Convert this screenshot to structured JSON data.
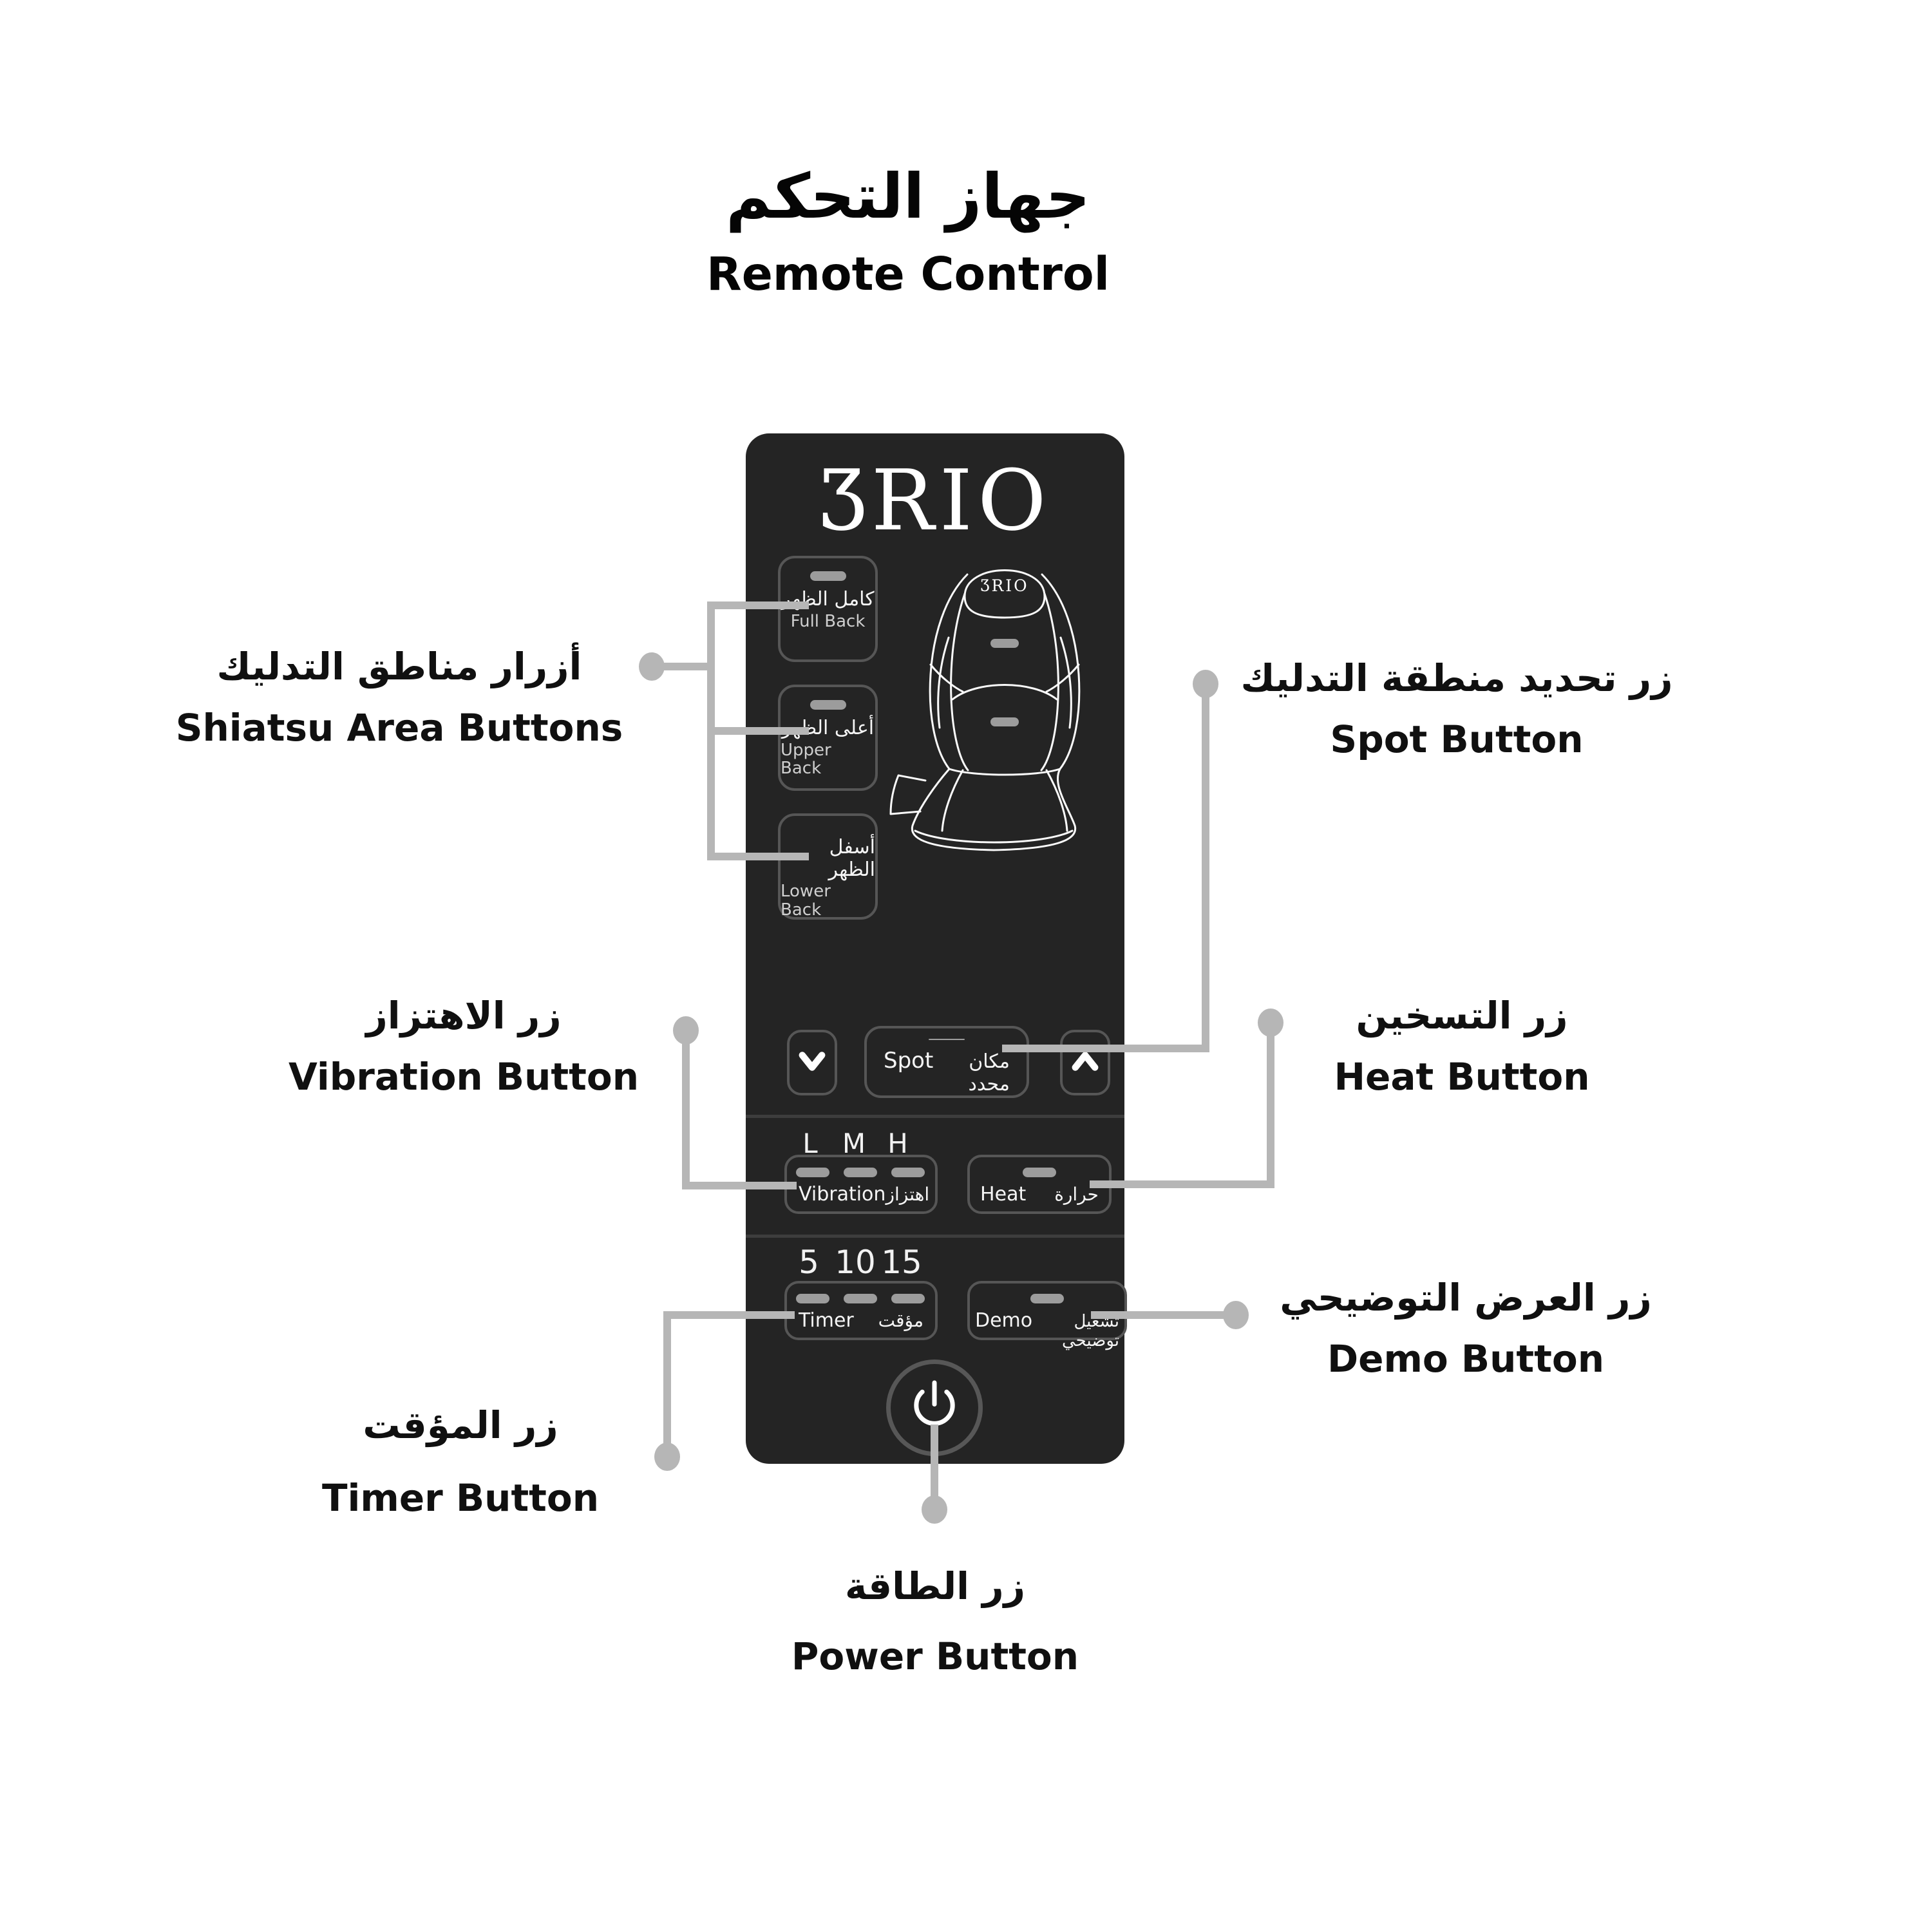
{
  "title": {
    "ar": "جهاز التحكم",
    "en": "Remote Control"
  },
  "brand": {
    "name": "BRIO",
    "stylized": "ƷRIO"
  },
  "remote": {
    "area_buttons": [
      {
        "ar": "كامل الظهر",
        "en": "Full Back"
      },
      {
        "ar": "أعلى الظهر",
        "en": "Upper Back"
      },
      {
        "ar": "أسفل الظهر",
        "en": "Lower Back"
      }
    ],
    "spot": {
      "en": "Spot",
      "ar": "مكان محدد"
    },
    "vibration": {
      "levels": [
        "L",
        "M",
        "H"
      ],
      "en": "Vibration",
      "ar": "اهتزاز"
    },
    "heat": {
      "en": "Heat",
      "ar": "حرارة"
    },
    "timer": {
      "durations": [
        "5",
        "10",
        "15"
      ],
      "en": "Timer",
      "ar": "مؤقت"
    },
    "demo": {
      "en": "Demo",
      "ar": "تشغيل توضيحي"
    }
  },
  "labels": {
    "shiatsu": {
      "ar": "أزرار مناطق التدليك",
      "en": "Shiatsu Area Buttons"
    },
    "spot": {
      "ar": "زر تحديد منطقة التدليك",
      "en": "Spot Button"
    },
    "vibration": {
      "ar": "زر الاهتزاز",
      "en": "Vibration Button"
    },
    "heat": {
      "ar": "زر التسخين",
      "en": "Heat Button"
    },
    "timer": {
      "ar": "زر المؤقت",
      "en": "Timer Button"
    },
    "demo": {
      "ar": "زر العرض التوضيحي",
      "en": "Demo Button"
    },
    "power": {
      "ar": "زر الطاقة",
      "en": "Power Button"
    }
  },
  "icons": {
    "chevron_down": "∨",
    "chevron_up": "∧",
    "power": "⏻"
  },
  "colors": {
    "remote_bg": "#242424",
    "button_border": "#565656",
    "led": "#9c9c9c",
    "callout": "#b6b6b6",
    "divider": "#3d3d3d",
    "text_light": "#f5f5f5",
    "text_dim": "#cfcfcf",
    "label_text": "#101010"
  }
}
